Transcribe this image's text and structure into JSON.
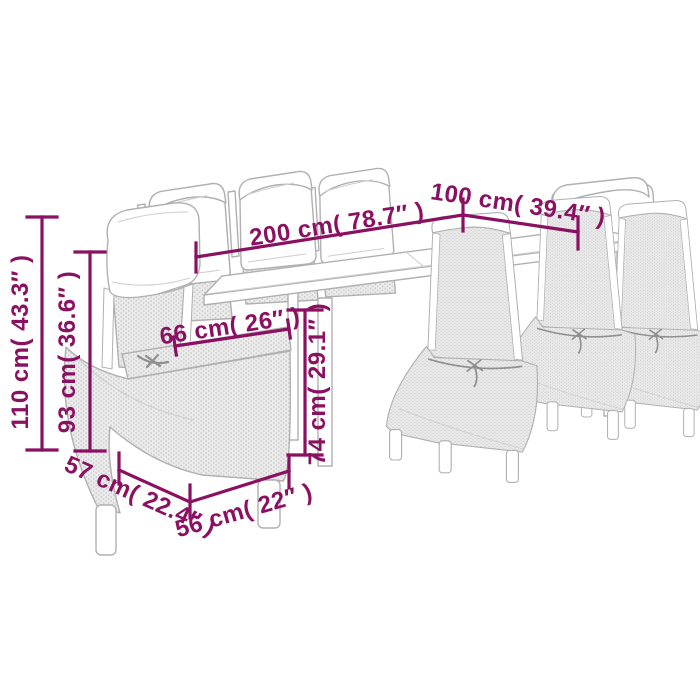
{
  "diagram": {
    "type": "product-dimension-sketch",
    "subject": "garden-dining-set-table-with-eight-chairs",
    "dimensions": {
      "overall_height": "110 cm( 43.3″ )",
      "backrest_height": "93 cm( 36.6″ )",
      "table_length": "200 cm( 78.7″ )",
      "table_width": "100 cm( 39.4″ )",
      "seat_width": "66 cm( 26″ )",
      "table_height": "74 cm( 29.1″ )",
      "chair_depth": "57 cm( 22.4″ )",
      "chair_width": "56 cm( 22″ )"
    },
    "colors": {
      "dimension": "#8a1162",
      "sketch": "#b0b0b0",
      "background": "#ffffff"
    }
  }
}
